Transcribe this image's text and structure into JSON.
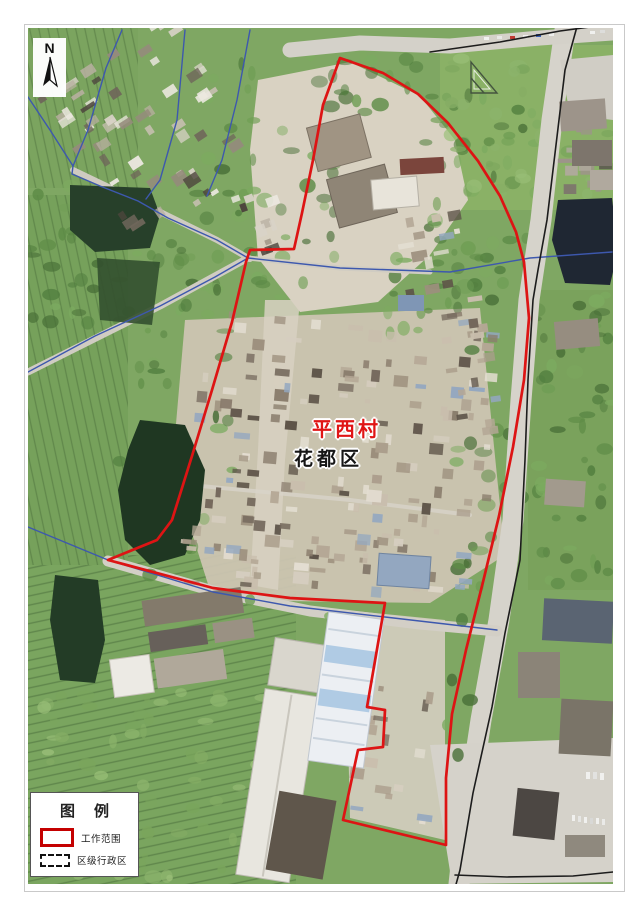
{
  "page": {
    "background": "#ffffff"
  },
  "map": {
    "region_label": {
      "text": "平西村",
      "color": "#e01515"
    },
    "district_label": {
      "text": "花都区",
      "color": "#161616"
    },
    "compass": {
      "label": "N"
    }
  },
  "legend": {
    "title": "图　例",
    "items": [
      {
        "label": "工作范围",
        "swatch": "work-scope-red-rect",
        "swatch_color": "#c40000"
      },
      {
        "label": "区级行政区",
        "swatch": "district-dashed-rect",
        "swatch_color": "#111111"
      }
    ]
  },
  "colors": {
    "boundary_red": "#dd1414",
    "admin_blue": "#3d58ae",
    "road_black": "#1c1c1c"
  },
  "overlays": {
    "red_boundary": {
      "name": "工作范围",
      "points": [
        [
          340,
          58
        ],
        [
          383,
          73
        ],
        [
          418,
          94
        ],
        [
          448,
          123
        ],
        [
          478,
          161
        ],
        [
          500,
          196
        ],
        [
          516,
          232
        ],
        [
          524,
          262
        ],
        [
          529,
          318
        ],
        [
          524,
          380
        ],
        [
          513,
          447
        ],
        [
          499,
          516
        ],
        [
          483,
          582
        ],
        [
          466,
          650
        ],
        [
          452,
          714
        ],
        [
          446,
          778
        ],
        [
          446,
          845
        ],
        [
          343,
          820
        ],
        [
          358,
          750
        ],
        [
          383,
          747
        ],
        [
          385,
          710
        ],
        [
          367,
          707
        ],
        [
          385,
          603
        ],
        [
          290,
          598
        ],
        [
          213,
          588
        ],
        [
          108,
          560
        ],
        [
          157,
          540
        ],
        [
          172,
          520
        ],
        [
          192,
          456
        ],
        [
          212,
          390
        ],
        [
          232,
          322
        ],
        [
          246,
          262
        ],
        [
          250,
          250
        ],
        [
          294,
          249
        ],
        [
          302,
          213
        ],
        [
          313,
          160
        ],
        [
          323,
          105
        ]
      ]
    },
    "blue_lines": {
      "name": "区级行政区",
      "lines": [
        [
          [
            28,
            97
          ],
          [
            50,
            130
          ],
          [
            73,
            166
          ]
        ],
        [
          [
            122,
            30
          ],
          [
            106,
            68
          ],
          [
            88,
            130
          ],
          [
            73,
            166
          ],
          [
            72,
            174
          ],
          [
            100,
            186
          ],
          [
            138,
            201
          ],
          [
            168,
            218
          ],
          [
            217,
            240
          ],
          [
            248,
            258
          ]
        ],
        [
          [
            185,
            30
          ],
          [
            177,
            120
          ],
          [
            160,
            180
          ],
          [
            146,
            199
          ]
        ],
        [
          [
            250,
            30
          ],
          [
            237,
            100
          ],
          [
            222,
            160
          ],
          [
            207,
            196
          ]
        ],
        [
          [
            28,
            372
          ],
          [
            95,
            336
          ],
          [
            160,
            306
          ],
          [
            215,
            277
          ],
          [
            248,
            258
          ],
          [
            340,
            268
          ],
          [
            450,
            272
          ],
          [
            530,
            258
          ],
          [
            612,
            252
          ]
        ],
        [
          [
            28,
            527
          ],
          [
            108,
            560
          ],
          [
            213,
            592
          ],
          [
            290,
            606
          ],
          [
            385,
            617
          ],
          [
            497,
            630
          ]
        ]
      ]
    },
    "black_lines": {
      "name": "道路",
      "lines": [
        [
          [
            578,
            23
          ],
          [
            565,
            70
          ],
          [
            553,
            170
          ],
          [
            547,
            220
          ],
          [
            538,
            270
          ],
          [
            533,
            300
          ],
          [
            528,
            380
          ],
          [
            525,
            460
          ],
          [
            520,
            560
          ],
          [
            505,
            633
          ],
          [
            492,
            707
          ],
          [
            473,
            793
          ],
          [
            460,
            870
          ],
          [
            455,
            888
          ]
        ],
        [
          [
            430,
            52
          ],
          [
            500,
            42
          ],
          [
            560,
            31
          ],
          [
            612,
            24
          ]
        ],
        [
          [
            455,
            875
          ],
          [
            507,
            877
          ],
          [
            573,
            876
          ],
          [
            613,
            872
          ]
        ]
      ]
    }
  }
}
